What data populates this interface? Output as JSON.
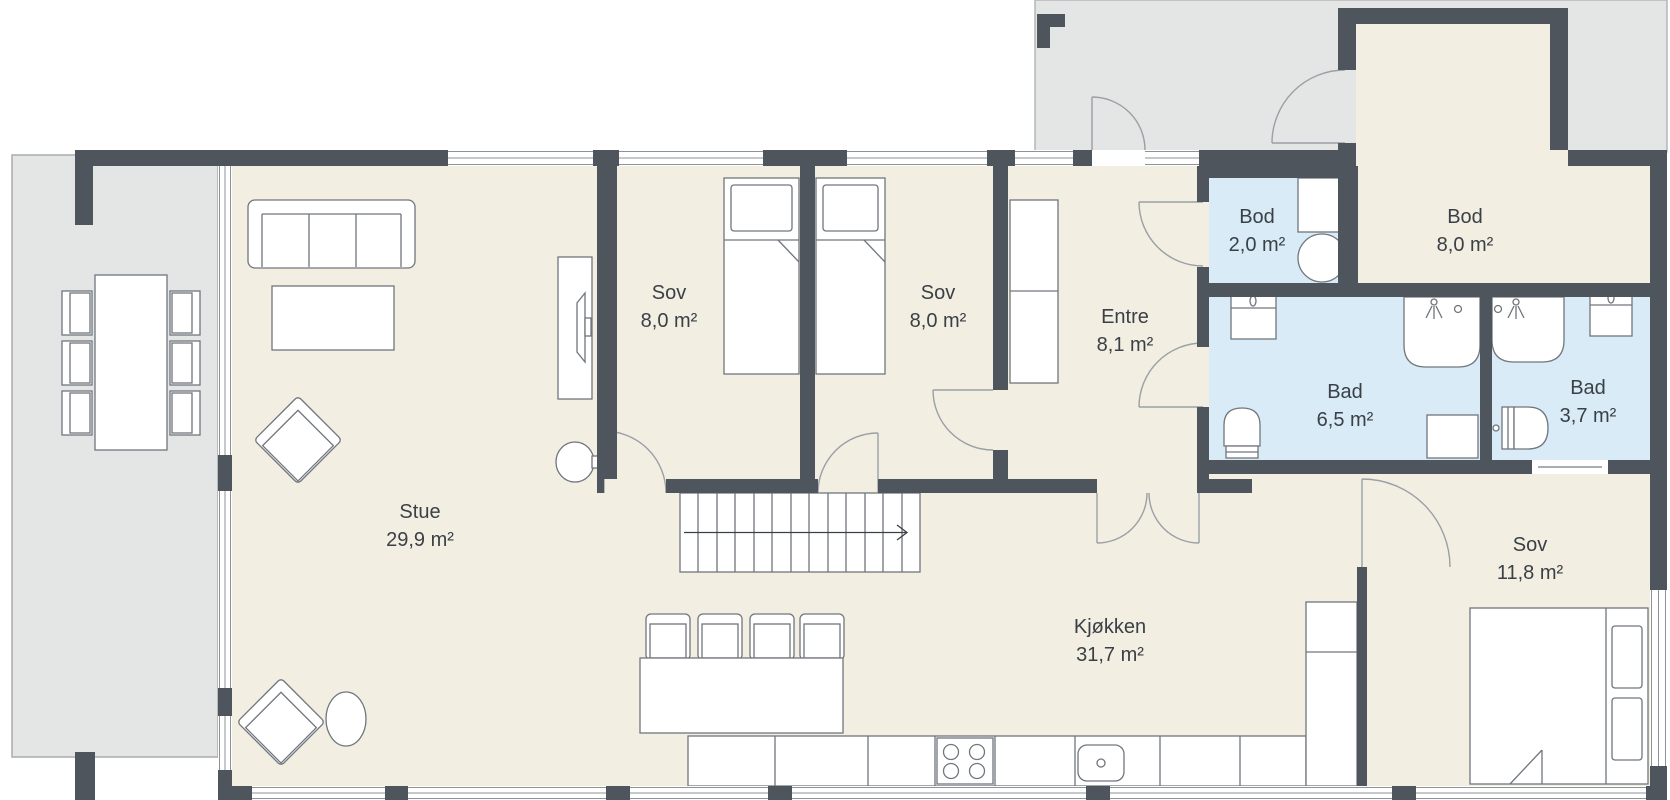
{
  "rooms": [
    {
      "name": "Stue",
      "area": "29,9 m²"
    },
    {
      "name": "Sov",
      "area": "8,0 m²"
    },
    {
      "name": "Sov",
      "area": "8,0 m²"
    },
    {
      "name": "Entre",
      "area": "8,1 m²"
    },
    {
      "name": "Bod",
      "area": "2,0 m²"
    },
    {
      "name": "Bod",
      "area": "8,0 m²"
    },
    {
      "name": "Bad",
      "area": "6,5 m²"
    },
    {
      "name": "Bad",
      "area": "3,7 m²"
    },
    {
      "name": "Sov",
      "area": "11,8 m²"
    },
    {
      "name": "Kjøkken",
      "area": "31,7 m²"
    }
  ],
  "colors": {
    "wall": "#4e555c",
    "interior_floor": "#f3eee2",
    "wet_room_floor": "#d9ebf7",
    "outdoor_floor": "#e4e5e5",
    "furniture_outline": "#70767d",
    "window_line": "#8e939a",
    "label_text": "#3a4046"
  },
  "icons": {
    "stairs_direction_arrow": "arrow-right",
    "shower_icon": "shower-spray",
    "cooktop_icon": "four-burners",
    "sink_icon": "basin-with-drain"
  }
}
